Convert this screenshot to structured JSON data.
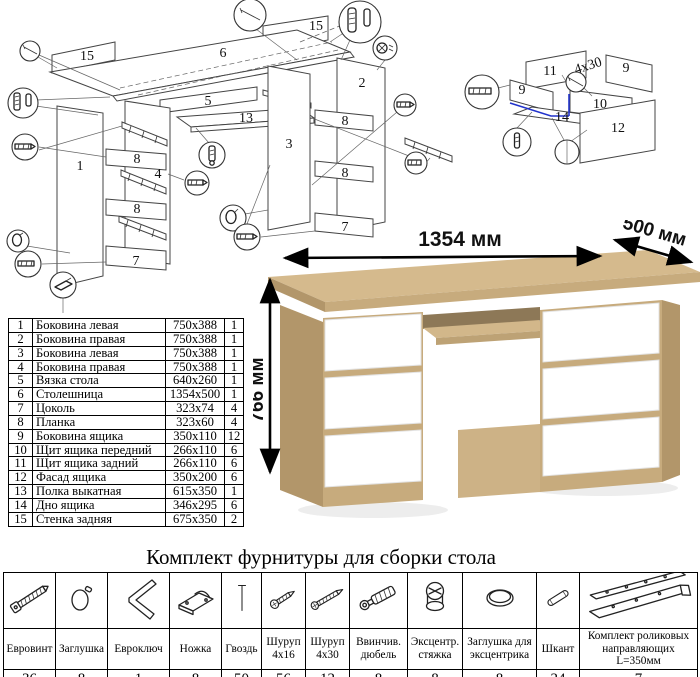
{
  "exploded_main": {
    "labels": [
      {
        "text": "15"
      },
      {
        "text": "6"
      },
      {
        "text": "15"
      },
      {
        "text": "5"
      },
      {
        "text": "13"
      },
      {
        "text": "1"
      },
      {
        "text": "4"
      },
      {
        "text": "8"
      },
      {
        "text": "8"
      },
      {
        "text": "7"
      },
      {
        "text": "3"
      },
      {
        "text": "2"
      },
      {
        "text": "8"
      },
      {
        "text": "8"
      },
      {
        "text": "7"
      }
    ]
  },
  "drawer_diagram": {
    "labels": [
      {
        "text": "11"
      },
      {
        "text": "9"
      },
      {
        "text": "9"
      },
      {
        "text": "10"
      },
      {
        "text": "14"
      },
      {
        "text": "12"
      }
    ],
    "annotation": "4x30"
  },
  "desk": {
    "width_label": "1354 мм",
    "depth_label": "500 мм",
    "height_label": "766 мм",
    "colors": {
      "oak_top": "#d5ba8d",
      "oak_front": "#c7ab7d",
      "oak_side": "#b2966a",
      "oak_shadow": "#8d7857",
      "drawer_white": "#ffffff"
    }
  },
  "parts_table": {
    "rows": [
      {
        "num": "1",
        "name": "Боковина левая",
        "size": "750x388",
        "qty": "1"
      },
      {
        "num": "2",
        "name": "Боковина правая",
        "size": "750x388",
        "qty": "1"
      },
      {
        "num": "3",
        "name": "Боковина левая",
        "size": "750x388",
        "qty": "1"
      },
      {
        "num": "4",
        "name": "Боковина правая",
        "size": "750x388",
        "qty": "1"
      },
      {
        "num": "5",
        "name": "Вязка стола",
        "size": "640x260",
        "qty": "1"
      },
      {
        "num": "6",
        "name": "Столешница",
        "size": "1354x500",
        "qty": "1"
      },
      {
        "num": "7",
        "name": "Цоколь",
        "size": "323x74",
        "qty": "4"
      },
      {
        "num": "8",
        "name": "Планка",
        "size": "323x60",
        "qty": "4"
      },
      {
        "num": "9",
        "name": "Боковина ящика",
        "size": "350x110",
        "qty": "12"
      },
      {
        "num": "10",
        "name": "Щит ящика передний",
        "size": "266x110",
        "qty": "6"
      },
      {
        "num": "11",
        "name": "Щит ящика задний",
        "size": "266x110",
        "qty": "6"
      },
      {
        "num": "12",
        "name": "Фасад ящика",
        "size": "350x200",
        "qty": "6"
      },
      {
        "num": "13",
        "name": "Полка выкатная",
        "size": "615x350",
        "qty": "1"
      },
      {
        "num": "14",
        "name": "Дно ящика",
        "size": "346x295",
        "qty": "6"
      },
      {
        "num": "15",
        "name": "Стенка задняя",
        "size": "675x350",
        "qty": "2"
      }
    ]
  },
  "hardware": {
    "title": "Комплект фурнитуры для сборки стола",
    "items": [
      {
        "name": "Евровинт",
        "qty": "36",
        "icon": "euro-screw-icon"
      },
      {
        "name": "Заглушка",
        "qty": "8",
        "icon": "cap-icon"
      },
      {
        "name": "Евроключ",
        "qty": "1",
        "icon": "hex-key-icon"
      },
      {
        "name": "Ножка",
        "qty": "8",
        "icon": "foot-icon"
      },
      {
        "name": "Гвоздь",
        "qty": "50",
        "icon": "nail-icon"
      },
      {
        "name": "Шуруп 4x16",
        "qty": "56",
        "icon": "screw-short-icon"
      },
      {
        "name": "Шуруп 4x30",
        "qty": "12",
        "icon": "screw-long-icon"
      },
      {
        "name": "Ввинчив. дюбель",
        "qty": "8",
        "icon": "screw-dowel-icon"
      },
      {
        "name": "Эксцентр. стяжка",
        "qty": "8",
        "icon": "cam-lock-icon"
      },
      {
        "name": "Заглушка для эксцентрика",
        "qty": "8",
        "icon": "cam-cap-icon"
      },
      {
        "name": "Шкант",
        "qty": "24",
        "icon": "wood-dowel-icon"
      },
      {
        "name": "Комплект роликовых направляющих L=350мм",
        "qty": "7",
        "icon": "roller-guides-icon"
      }
    ]
  }
}
